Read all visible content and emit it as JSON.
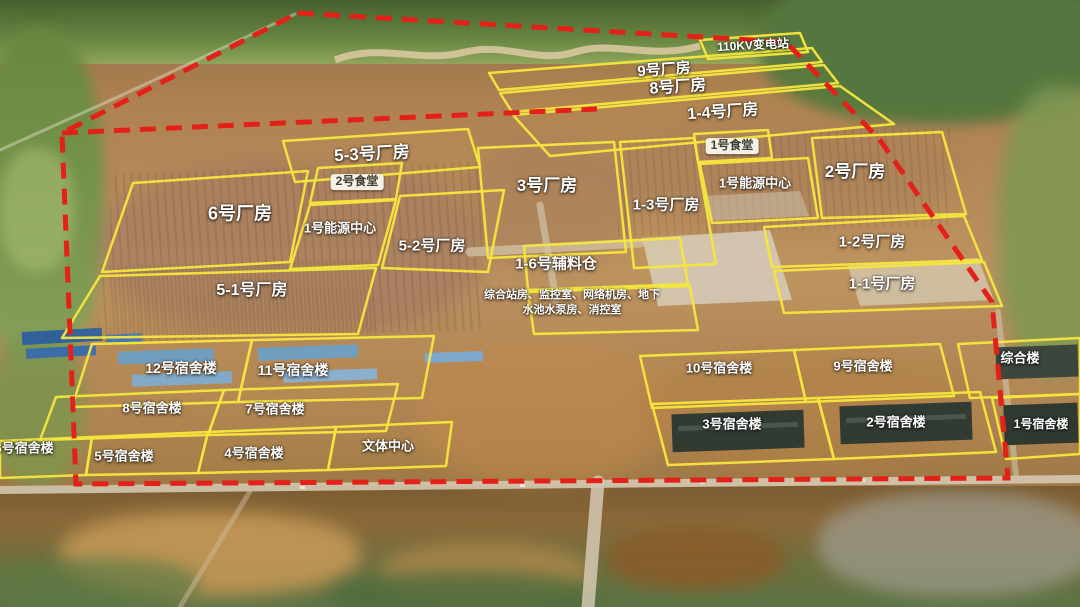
{
  "map": {
    "width": 1080,
    "height": 607,
    "colors": {
      "boundary_red": "#e32119",
      "plot_yellow": "#f6e73e",
      "label_text": "#ffffff"
    },
    "boundary": {
      "outer_points": "298,13 786,42 880,140 992,302 1008,478 76,484 62,133",
      "phase_line_points": "62,133 350,120 597,109"
    },
    "zones": [
      {
        "id": "substation-110kv",
        "label": "110KV变电站",
        "points": "700,40 800,33 808,52 708,59",
        "lx": 753,
        "ly": 46,
        "fs": 12,
        "rot": -3
      },
      {
        "id": "factory-9",
        "label": "9号厂房",
        "points": "489,73 812,48 822,62 499,90",
        "lx": 664,
        "ly": 70,
        "fs": 15,
        "rot": -4
      },
      {
        "id": "factory-8",
        "label": "8号厂房",
        "points": "500,93 824,65 838,83 512,112",
        "lx": 678,
        "ly": 88,
        "fs": 16,
        "rot": -4
      },
      {
        "id": "factory-1-4",
        "label": "1-4号厂房",
        "points": "513,115 840,86 894,124 550,156",
        "lx": 723,
        "ly": 113,
        "fs": 16,
        "rot": -4
      },
      {
        "id": "factory-5-3",
        "label": "5-3号厂房",
        "points": "283,141 468,129 480,167 295,182",
        "lx": 372,
        "ly": 154,
        "fs": 17,
        "rot": -3
      },
      {
        "id": "canteen-2",
        "label": "2号食堂",
        "points": "318,168 402,163 396,199 310,203",
        "lx": 357,
        "ly": 182,
        "fs": 12,
        "style": "pill"
      },
      {
        "id": "factory-6",
        "label": "6号厂房",
        "points": "133,183 308,171 290,262 102,272",
        "lx": 240,
        "ly": 214,
        "fs": 18
      },
      {
        "id": "energy-center-west",
        "label": "1号能源中心",
        "points": "310,205 396,200 378,265 290,269",
        "lx": 340,
        "ly": 229,
        "fs": 13
      },
      {
        "id": "factory-5-2",
        "label": "5-2号厂房",
        "points": "400,196 504,190 488,272 382,268",
        "lx": 432,
        "ly": 246,
        "fs": 15
      },
      {
        "id": "factory-5-1",
        "label": "5-1号厂房",
        "points": "100,276 376,268 358,334 62,338",
        "lx": 252,
        "ly": 291,
        "fs": 16
      },
      {
        "id": "factory-3",
        "label": "3号厂房",
        "points": "478,148 614,142 626,252 488,258",
        "lx": 547,
        "ly": 186,
        "fs": 17
      },
      {
        "id": "warehouse-aux",
        "label": "1-6号辅料仓",
        "points": "524,246 680,238 688,284 528,290",
        "lx": 556,
        "ly": 264,
        "fs": 15
      },
      {
        "id": "service-rooms",
        "label": "综合站房、监控室、网络机房、地下\n水池水泵房、消控室",
        "points": "528,292 690,286 698,330 534,334",
        "lx": 572,
        "ly": 303,
        "fs": 11,
        "style": "note"
      },
      {
        "id": "canteen-1",
        "label": "1号食堂",
        "points": "694,134 768,130 772,158 698,162",
        "lx": 732,
        "ly": 146,
        "fs": 12,
        "style": "pill"
      },
      {
        "id": "factory-1-3",
        "label": "1-3号厂房",
        "points": "620,142 694,138 716,264 634,268",
        "lx": 666,
        "ly": 205,
        "fs": 15
      },
      {
        "id": "energy-center-east",
        "label": "1号能源中心",
        "points": "700,164 808,158 818,218 712,223",
        "lx": 755,
        "ly": 184,
        "fs": 13
      },
      {
        "id": "factory-2",
        "label": "2号厂房",
        "points": "812,138 942,132 966,214 822,218",
        "lx": 855,
        "ly": 172,
        "fs": 17
      },
      {
        "id": "factory-1-2",
        "label": "1-2号厂房",
        "points": "764,227 964,216 982,260 772,267",
        "lx": 872,
        "ly": 242,
        "fs": 15
      },
      {
        "id": "factory-1-1",
        "label": "1-1号厂房",
        "points": "774,271 984,262 1002,306 784,313",
        "lx": 882,
        "ly": 284,
        "fs": 15
      },
      {
        "id": "dorm-12",
        "label": "12号宿舍楼",
        "points": "92,344 252,340 238,402 72,407",
        "lx": 181,
        "ly": 368,
        "fs": 14
      },
      {
        "id": "dorm-11",
        "label": "11号宿舍楼",
        "points": "252,340 434,336 422,398 238,402",
        "lx": 293,
        "ly": 370,
        "fs": 14
      },
      {
        "id": "dorm-10",
        "label": "10号宿舍楼",
        "points": "640,356 794,350 806,402 652,408",
        "lx": 719,
        "ly": 369,
        "fs": 13
      },
      {
        "id": "dorm-9",
        "label": "9号宿舍楼",
        "points": "794,350 940,344 954,396 806,402",
        "lx": 863,
        "ly": 367,
        "fs": 13
      },
      {
        "id": "complex-building",
        "label": "综合楼",
        "points": "958,344 1080,338 1080,394 970,398",
        "lx": 1020,
        "ly": 359,
        "fs": 13
      },
      {
        "id": "dorm-8",
        "label": "8号宿舍楼",
        "points": "56,397 224,390 208,435 40,440",
        "lx": 152,
        "ly": 409,
        "fs": 13
      },
      {
        "id": "dorm-7",
        "label": "7号宿舍楼",
        "points": "224,390 398,384 386,431 208,435",
        "lx": 275,
        "ly": 410,
        "fs": 13
      },
      {
        "id": "dorm-6",
        "label": "6号宿舍楼",
        "points": "0,441 92,437 86,475 0,478",
        "lx": 24,
        "ly": 449,
        "fs": 13
      },
      {
        "id": "dorm-5",
        "label": "5号宿舍楼",
        "points": "92,437 208,432 198,473 86,475",
        "lx": 124,
        "ly": 457,
        "fs": 13
      },
      {
        "id": "dorm-4",
        "label": "4号宿舍楼",
        "points": "208,432 336,427 328,470 198,473",
        "lx": 254,
        "ly": 454,
        "fs": 13
      },
      {
        "id": "culture-sports-center",
        "label": "文体中心",
        "points": "336,427 452,422 446,466 328,470",
        "lx": 388,
        "ly": 447,
        "fs": 13
      },
      {
        "id": "dorm-3",
        "label": "3号宿舍楼",
        "points": "652,404 818,398 834,459 668,465",
        "lx": 732,
        "ly": 425,
        "fs": 13
      },
      {
        "id": "dorm-2",
        "label": "2号宿舍楼",
        "points": "818,398 980,392 996,452 834,459",
        "lx": 896,
        "ly": 423,
        "fs": 13
      },
      {
        "id": "dorm-1",
        "label": "1号宿舍楼",
        "points": "992,398 1080,394 1080,454 1006,459",
        "lx": 1041,
        "ly": 425,
        "fs": 12
      }
    ]
  }
}
